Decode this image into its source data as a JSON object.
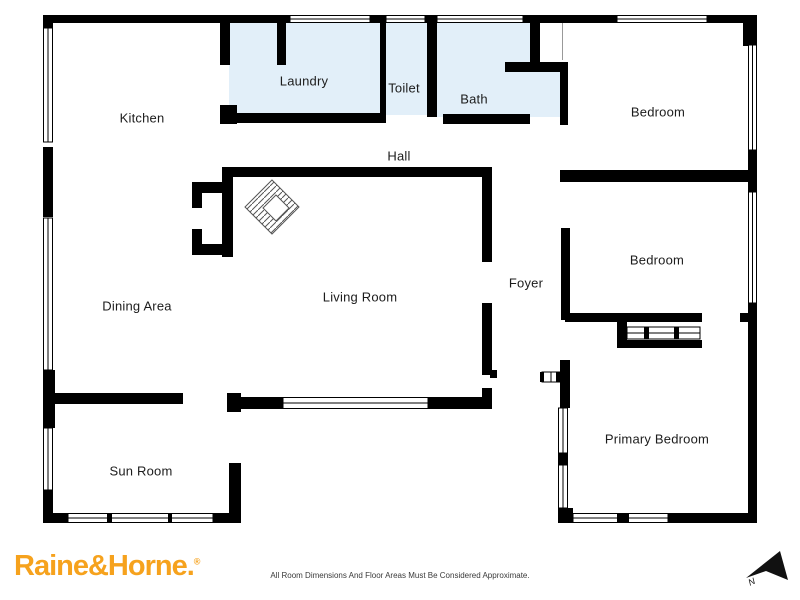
{
  "plan": {
    "rooms": {
      "kitchen": {
        "label": "Kitchen"
      },
      "laundry": {
        "label": "Laundry"
      },
      "toilet": {
        "label": "Toilet"
      },
      "bath": {
        "label": "Bath"
      },
      "hall": {
        "label": "Hall"
      },
      "bedroom_ne": {
        "label": "Bedroom"
      },
      "bedroom_e": {
        "label": "Bedroom"
      },
      "dining_area": {
        "label": "Dining Area"
      },
      "living_room": {
        "label": "Living Room"
      },
      "foyer": {
        "label": "Foyer"
      },
      "sun_room": {
        "label": "Sun Room"
      },
      "primary_bedroom": {
        "label": "Primary Bedroom"
      }
    },
    "symbols": {
      "north_label": "N",
      "fireplace": "fireplace-hatch-symbol"
    },
    "colors": {
      "wall": "#000000",
      "wet_area_fill": "#e2eff9",
      "label_text": "#1c1c1c",
      "logo": "#f6a21d"
    }
  },
  "footer": {
    "logo_text": "Raine&Horne.",
    "logo_registered": "®",
    "disclaimer": "All Room Dimensions And Floor Areas Must Be Considered Approximate."
  }
}
